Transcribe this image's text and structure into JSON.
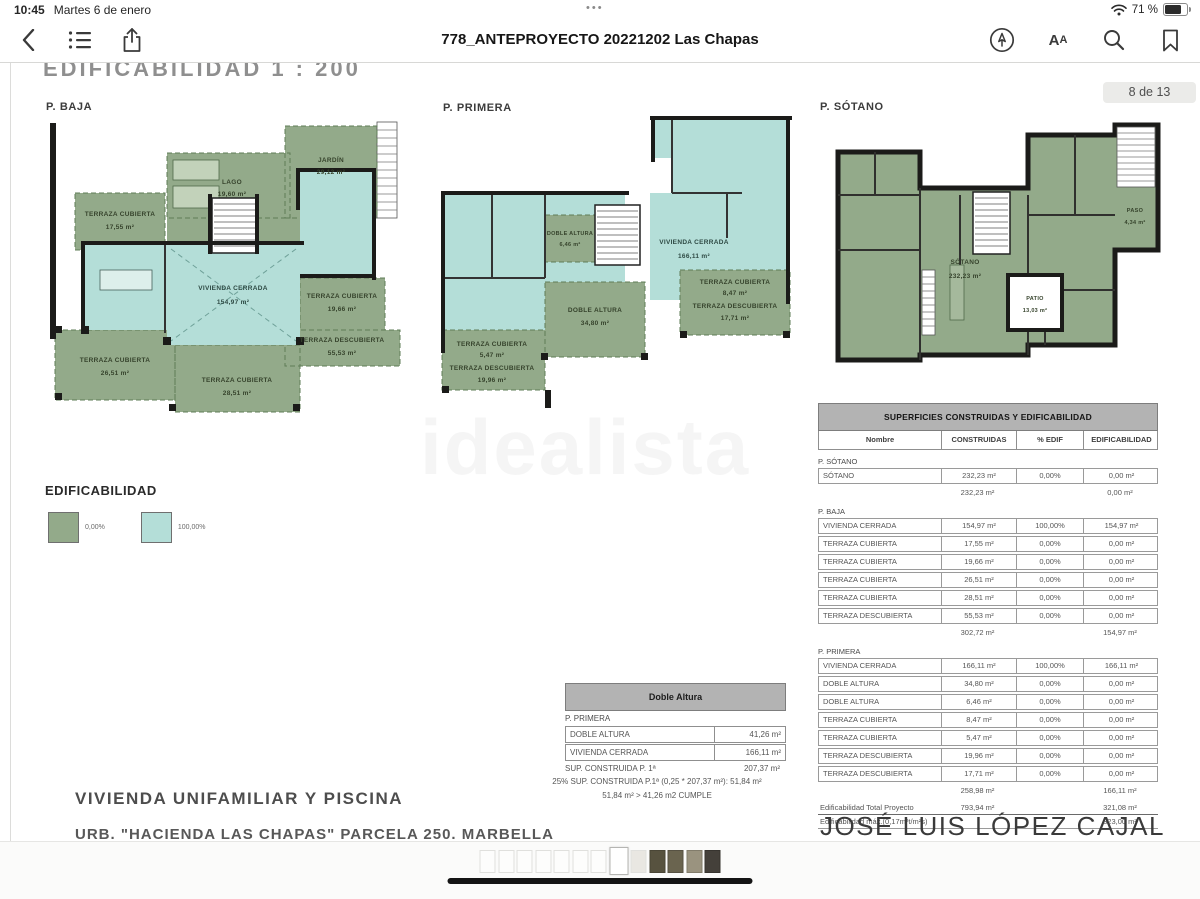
{
  "status_bar": {
    "time": "10:45",
    "date": "Martes 6 de enero",
    "battery": "71 %"
  },
  "toolbar": {
    "title": "778_ANTEPROYECTO 20221202 Las Chapas"
  },
  "page_badge": "8 de 13",
  "document": {
    "sheet_title": "EDIFICABILIDAD  1 : 200",
    "watermark": "idealista",
    "plans": [
      {
        "name": "P. BAJA",
        "rooms": [
          {
            "n": "JARDÍN",
            "a": "29,12 m²"
          },
          {
            "n": "LAGO",
            "a": "19,60 m²"
          },
          {
            "n": "TERRAZA CUBIERTA",
            "a": "17,55 m²"
          },
          {
            "n": "VIVIENDA CERRADA",
            "a": "154,97 m²"
          },
          {
            "n": "TERRAZA CUBIERTA",
            "a": "19,66 m²"
          },
          {
            "n": "TERRAZA DESCUBIERTA",
            "a": "55,53 m²"
          },
          {
            "n": "TERRAZA CUBIERTA",
            "a": "26,51 m²"
          },
          {
            "n": "TERRAZA CUBIERTA",
            "a": "28,51 m²"
          }
        ]
      },
      {
        "name": "P. PRIMERA",
        "rooms": [
          {
            "n": "DOBLE ALTURA",
            "a": "6,46 m²"
          },
          {
            "n": "VIVIENDA CERRADA",
            "a": "166,11 m²"
          },
          {
            "n": "DOBLE ALTURA",
            "a": "34,80 m²"
          },
          {
            "n": "TERRAZA CUBIERTA",
            "a": "8,47 m²"
          },
          {
            "n": "TERRAZA DESCUBIERTA",
            "a": "17,71 m²"
          },
          {
            "n": "TERRAZA CUBIERTA",
            "a": "5,47 m²"
          },
          {
            "n": "TERRAZA DESCUBIERTA",
            "a": "19,96 m²"
          }
        ]
      },
      {
        "name": "P. SÓTANO",
        "rooms": [
          {
            "n": "SÓTANO",
            "a": "232,23 m²"
          },
          {
            "n": "PATIO",
            "a": "13,03 m²"
          },
          {
            "n": "PASO",
            "a": "4,34 m²"
          }
        ]
      }
    ],
    "legend": {
      "title": "EDIFICABILIDAD",
      "items": [
        {
          "label": "0,00%"
        },
        {
          "label": "100,00%"
        }
      ]
    },
    "colors": {
      "green": "#93aa8a",
      "cyan": "#b4ded8",
      "wall": "#1b1b19"
    },
    "doble_altura": {
      "title": "Doble Altura",
      "section": "P. PRIMERA",
      "rows": [
        [
          "DOBLE ALTURA",
          "41,26 m²"
        ],
        [
          "VIVIENDA CERRADA",
          "166,11 m²"
        ]
      ],
      "total_label": "SUP. CONSTRUIDA P. 1ª",
      "total_value": "207,37 m²",
      "note1": "25% SUP. CONSTRUIDA P.1ª (0,25 * 207,37 m²):   51,84 m²",
      "note2": "51,84 m²  >  41,26 m2  CUMPLE"
    },
    "main_table": {
      "title": "SUPERFICIES CONSTRUIDAS Y EDIFICABILIDAD",
      "columns": [
        "Nombre",
        "CONSTRUIDAS",
        "% EDIF",
        "EDIFICABILIDAD"
      ],
      "sections": [
        {
          "name": "P. SÓTANO",
          "rows": [
            [
              "SÓTANO",
              "232,23 m²",
              "0,00%",
              "0,00 m²"
            ]
          ],
          "subtotal": [
            "232,23 m²",
            "0,00 m²"
          ]
        },
        {
          "name": "P. BAJA",
          "rows": [
            [
              "VIVIENDA CERRADA",
              "154,97 m²",
              "100,00%",
              "154,97 m²"
            ],
            [
              "TERRAZA CUBIERTA",
              "17,55 m²",
              "0,00%",
              "0,00 m²"
            ],
            [
              "TERRAZA CUBIERTA",
              "19,66 m²",
              "0,00%",
              "0,00 m²"
            ],
            [
              "TERRAZA CUBIERTA",
              "26,51 m²",
              "0,00%",
              "0,00 m²"
            ],
            [
              "TERRAZA CUBIERTA",
              "28,51 m²",
              "0,00%",
              "0,00 m²"
            ],
            [
              "TERRAZA DESCUBIERTA",
              "55,53 m²",
              "0,00%",
              "0,00 m²"
            ]
          ],
          "subtotal": [
            "302,72 m²",
            "154,97 m²"
          ]
        },
        {
          "name": "P. PRIMERA",
          "rows": [
            [
              "VIVIENDA CERRADA",
              "166,11 m²",
              "100,00%",
              "166,11 m²"
            ],
            [
              "DOBLE ALTURA",
              "34,80 m²",
              "0,00%",
              "0,00 m²"
            ],
            [
              "DOBLE ALTURA",
              "6,46 m²",
              "0,00%",
              "0,00 m²"
            ],
            [
              "TERRAZA CUBIERTA",
              "8,47 m²",
              "0,00%",
              "0,00 m²"
            ],
            [
              "TERRAZA CUBIERTA",
              "5,47 m²",
              "0,00%",
              "0,00 m²"
            ],
            [
              "TERRAZA DESCUBIERTA",
              "19,96 m²",
              "0,00%",
              "0,00 m²"
            ],
            [
              "TERRAZA DESCUBIERTA",
              "17,71 m²",
              "0,00%",
              "0,00 m²"
            ]
          ],
          "subtotal": [
            "258,98 m²",
            "166,11 m²"
          ]
        }
      ],
      "totals": [
        {
          "label": "Edificabilidad Total Proyecto",
          "constructed": "793,94 m²",
          "edificability": "321,08 m²"
        },
        {
          "label": "Edificabilidad máx.(0,17m²t/m²s)",
          "constructed": "",
          "edificability": "323,00 m²"
        }
      ]
    },
    "footer": {
      "project": "VIVIENDA UNIFAMILIAR Y PISCINA",
      "address": "URB. \"HACIENDA LAS CHAPAS\" PARCELA 250. MARBELLA",
      "architect": "JOSÉ LUIS LÓPEZ CAJAL"
    }
  },
  "thumbnails": {
    "count": 13,
    "current": 8
  }
}
